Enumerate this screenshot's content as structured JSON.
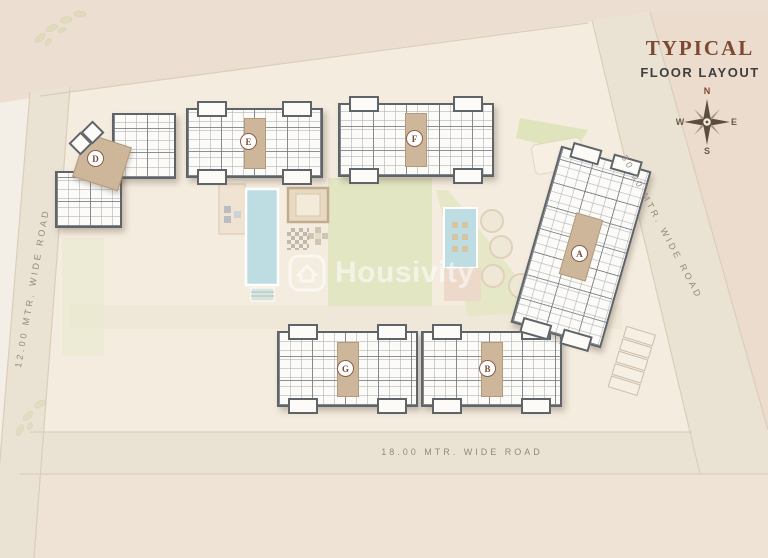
{
  "header": {
    "title": "TYPICAL",
    "subtitle": "FLOOR LAYOUT"
  },
  "compass": {
    "north": "N",
    "east": "E",
    "south": "S",
    "west": "W"
  },
  "watermark": {
    "brand": "Housivity"
  },
  "roads": {
    "left": {
      "label": "12.00 MTR. WIDE ROAD"
    },
    "right": {
      "label": "30.00 MTR. WIDE ROAD"
    },
    "bottom": {
      "label": "18.00 MTR. WIDE ROAD"
    }
  },
  "buildings": {
    "a": {
      "label": "A"
    },
    "b": {
      "label": "B"
    },
    "d": {
      "label": "D"
    },
    "e": {
      "label": "E"
    },
    "f": {
      "label": "F"
    },
    "g": {
      "label": "G"
    }
  },
  "colors": {
    "accent_brown": "#7c4a33",
    "ground": "#f4ecdf",
    "outer_ground": "#ecdfd1",
    "road": "#eae2d3",
    "lawn_green": "#e3e6c3",
    "pool_blue": "#bedde2",
    "building_wall": "#5f6468",
    "core_tan": "#cdb69a"
  }
}
